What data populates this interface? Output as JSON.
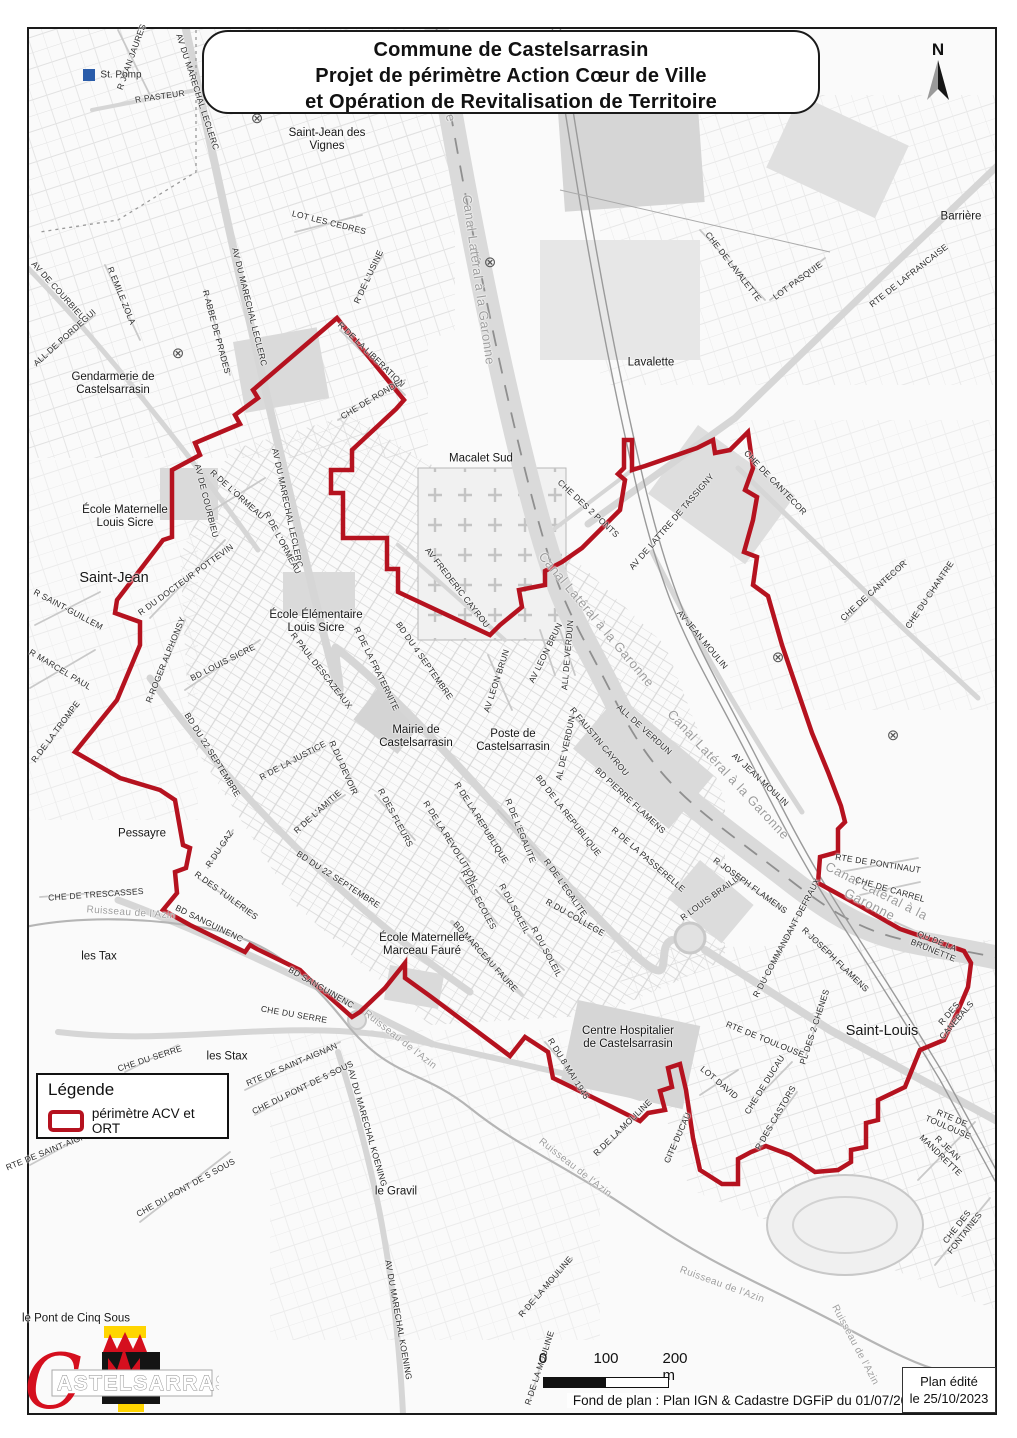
{
  "title_box": {
    "lines": [
      "Commune de Castelsarrasin",
      "Projet de périmètre Action Cœur de Ville",
      "et Opération de Revitalisation de Territoire"
    ]
  },
  "north_label": "N",
  "legend": {
    "title": "Légende",
    "item_label": "périmètre ACV et ORT"
  },
  "scale_bar": {
    "tick0": "0",
    "tick1": "100",
    "tick2": "200 m"
  },
  "credits": {
    "basemap": "Fond de plan : Plan IGN & Cadastre DGFiP du 01/07/2023",
    "edited_line1": "Plan édité",
    "edited_line2": "le 25/10/2023"
  },
  "logo": {
    "initial": "C",
    "name": "ASTELSARRASIN"
  },
  "colors": {
    "perimeter": "#b5121f",
    "canal_label": "#9c9c9c",
    "st_pomp_blue": "#2a5caa",
    "logo_red": "#d50f1e",
    "logo_yellow": "#ffd500",
    "logo_black": "#141414"
  },
  "perimeter_path": "M337,318 L404,400 L396,409 L352,450 L352,470 L331,470 L331,493 L343,493 L343,538 L387,538 L387,569 L398,569 L398,592 L490,635 L500,625 L522,607 L519,590 L545,585 L545,571 L562,562 L582,548 L605,525 L620,510 L625,480 L618,474 L624,468 L624,440 L632,440 L632,470 L645,466 L697,448 L713,440 L715,453 L730,450 L748,432 L753,468 L745,490 L757,497 L753,520 L744,552 L757,557 L753,585 L768,596 L782,645 L798,692 L812,733 L828,772 L841,806 L845,822 L838,829 L838,852 L820,857 L818,883 L860,906 L900,929 L944,944 L964,951 L971,963 L968,987 L957,1013 L944,1040 L920,1050 L905,1087 L878,1100 L878,1120 L866,1123 L866,1147 L851,1150 L851,1162 L838,1170 L815,1172 L790,1155 L766,1146 L751,1152 L738,1159 L738,1184 L722,1184 L700,1170 L693,1138 L686,1090 L680,1064 L668,1068 L672,1087 L660,1091 L665,1110 L648,1113 L640,1121 L598,1100 L553,1078 L548,1052 L525,1037 L510,1056 L430,996 L405,978 L405,963 L385,988 L360,1012 L352,1017 L307,977 L300,970 L257,949 L250,945 L245,952 L190,925 L163,910 L177,893 L175,872 L186,868 L190,848 L183,845 L175,800 L160,790 L120,778 L75,752 L117,700 L140,645 L140,622 L115,613 L117,600 L163,540 L172,537 L172,470 L200,455 L195,443 L240,424 L235,415 L258,398 L253,390 Z",
  "symbols": [
    {
      "x": 257,
      "y": 118
    },
    {
      "x": 178,
      "y": 353
    },
    {
      "x": 490,
      "y": 262
    },
    {
      "x": 778,
      "y": 657
    },
    {
      "x": 893,
      "y": 735
    }
  ],
  "map_labels": [
    {
      "t": "R JEAN JAURES",
      "x": 132,
      "y": 57,
      "r": -70
    },
    {
      "t": "R PASTEUR",
      "x": 160,
      "y": 97,
      "r": -8
    },
    {
      "t": "AV DU MARECHAL LECLERC",
      "x": 197,
      "y": 92,
      "r": 72
    },
    {
      "t": "St. Pomp",
      "x": 121,
      "y": 75,
      "c": "pl-sm"
    },
    {
      "t": "Saint-Jean des\nVignes",
      "x": 327,
      "y": 140,
      "c": "pl"
    },
    {
      "t": "LOT LES CEDRES",
      "x": 329,
      "y": 223,
      "r": 14
    },
    {
      "t": "R DE L'USINE",
      "x": 369,
      "y": 277,
      "r": -65
    },
    {
      "t": "R DE LA LIBERATION",
      "x": 371,
      "y": 355,
      "r": 44
    },
    {
      "t": "CHE DE RONDE",
      "x": 371,
      "y": 400,
      "r": -31
    },
    {
      "t": "Garonne",
      "x": 446,
      "y": 95,
      "r": 80,
      "c": "wt"
    },
    {
      "t": "Canal Latéral à la Garonne",
      "x": 478,
      "y": 280,
      "r": 82,
      "c": "wt"
    },
    {
      "t": "Macalet Sud",
      "x": 481,
      "y": 459,
      "c": "pl"
    },
    {
      "t": "Lavalette",
      "x": 651,
      "y": 363,
      "c": "pl"
    },
    {
      "t": "CHE DE LAVALETTE",
      "x": 733,
      "y": 267,
      "r": 52
    },
    {
      "t": "LOT PASQUIE",
      "x": 798,
      "y": 281,
      "r": -36
    },
    {
      "t": "RTE DE LAFRANCAISE",
      "x": 909,
      "y": 276,
      "r": -38
    },
    {
      "t": "Barrière",
      "x": 961,
      "y": 217,
      "c": "pl"
    },
    {
      "t": "Gendarmerie de\nCastelsarrasin",
      "x": 113,
      "y": 384,
      "c": "pl"
    },
    {
      "t": "AV DE COURBIEU",
      "x": 58,
      "y": 291,
      "r": 48
    },
    {
      "t": "R EMILE ZOLA",
      "x": 121,
      "y": 296,
      "r": 68
    },
    {
      "t": "ALL DE PORDEGUI",
      "x": 65,
      "y": 338,
      "r": -42
    },
    {
      "t": "R ABBE DE PRADES",
      "x": 216,
      "y": 332,
      "r": 75
    },
    {
      "t": "AV DU MARECHAL LECLERC",
      "x": 249,
      "y": 307,
      "r": 76
    },
    {
      "t": "AV DU MARECHAL LECLERC",
      "x": 287,
      "y": 508,
      "r": 78
    },
    {
      "t": "École Maternelle\nLouis Sicre",
      "x": 125,
      "y": 517,
      "c": "pl"
    },
    {
      "t": "Saint-Jean",
      "x": 114,
      "y": 578,
      "c": "pl-lg"
    },
    {
      "t": "R SAINT-GUILLEM",
      "x": 68,
      "y": 610,
      "r": 28
    },
    {
      "t": "R MARCEL PAUL",
      "x": 60,
      "y": 670,
      "r": 31
    },
    {
      "t": "R DE LA TROMPE",
      "x": 56,
      "y": 732,
      "r": -53
    },
    {
      "t": "R DU DOCTEUR POTTEVIN",
      "x": 186,
      "y": 580,
      "r": -36
    },
    {
      "t": "R ROGER ALPHONSY",
      "x": 166,
      "y": 660,
      "r": -68
    },
    {
      "t": "BD LOUIS SICRE",
      "x": 223,
      "y": 663,
      "r": -27
    },
    {
      "t": "AV DE COURBIEU",
      "x": 206,
      "y": 501,
      "r": 76
    },
    {
      "t": "R DE L'ORMEAU",
      "x": 237,
      "y": 495,
      "r": 42
    },
    {
      "t": "R DE L'ORMEAU",
      "x": 282,
      "y": 543,
      "r": 62
    },
    {
      "t": "École Élémentaire\nLouis Sicre",
      "x": 316,
      "y": 622,
      "c": "pl"
    },
    {
      "t": "R PAUL DESCAZEAUX",
      "x": 321,
      "y": 671,
      "r": 52
    },
    {
      "t": "R DE LA FRATERNITE",
      "x": 376,
      "y": 669,
      "r": 64
    },
    {
      "t": "BD DU 4 SEPTEMBRE",
      "x": 424,
      "y": 661,
      "r": 55
    },
    {
      "t": "Mairie de\nCastelsarrasin",
      "x": 416,
      "y": 737,
      "c": "pl"
    },
    {
      "t": "Poste de\nCastelsarrasin",
      "x": 513,
      "y": 741,
      "c": "pl"
    },
    {
      "t": "AV LEON BRUN",
      "x": 497,
      "y": 681,
      "r": -72
    },
    {
      "t": "AV LEON BRUN",
      "x": 546,
      "y": 653,
      "r": -64
    },
    {
      "t": "ALL DE VERDUN",
      "x": 568,
      "y": 655,
      "r": -85
    },
    {
      "t": "ALL DE VERDUN",
      "x": 644,
      "y": 730,
      "r": 42
    },
    {
      "t": "AL DE VERDUN",
      "x": 566,
      "y": 748,
      "r": -78
    },
    {
      "t": "R FAUSTIN CAYROU",
      "x": 599,
      "y": 742,
      "r": 50
    },
    {
      "t": "R DE LA JUSTICE",
      "x": 293,
      "y": 761,
      "r": -28
    },
    {
      "t": "R DU DEVOIR",
      "x": 343,
      "y": 768,
      "r": 66
    },
    {
      "t": "R DE L'AMITIE",
      "x": 318,
      "y": 812,
      "r": -42
    },
    {
      "t": "R DES FLEURS",
      "x": 395,
      "y": 818,
      "r": 62
    },
    {
      "t": "BD DU 22 SEPTEMBRE",
      "x": 212,
      "y": 755,
      "r": 58
    },
    {
      "t": "BD DU 22 SEPTEMBRE",
      "x": 338,
      "y": 880,
      "r": 33
    },
    {
      "t": "R DE LA REVOLUTION",
      "x": 450,
      "y": 842,
      "r": 58
    },
    {
      "t": "R DE LA REPUBLIQUE",
      "x": 481,
      "y": 823,
      "r": 58
    },
    {
      "t": "R DE L'EGALITE",
      "x": 520,
      "y": 831,
      "r": 68
    },
    {
      "t": "R DE L'EGALITE",
      "x": 565,
      "y": 888,
      "r": 55
    },
    {
      "t": "BD DE LA REPUBLIQUE",
      "x": 568,
      "y": 816,
      "r": 52
    },
    {
      "t": "R DU COLLEGE",
      "x": 575,
      "y": 918,
      "r": 30
    },
    {
      "t": "R DES ECOLES",
      "x": 478,
      "y": 900,
      "r": 62
    },
    {
      "t": "R DU SOLEIL",
      "x": 514,
      "y": 909,
      "r": 62
    },
    {
      "t": "R DU SOLEIL",
      "x": 546,
      "y": 952,
      "r": 62
    },
    {
      "t": "BD MARCEAU FAURE",
      "x": 485,
      "y": 957,
      "r": 48
    },
    {
      "t": "École Maternelle\nMarceau Fauré",
      "x": 422,
      "y": 945,
      "c": "pl"
    },
    {
      "t": "Pessayre",
      "x": 142,
      "y": 834,
      "c": "pl"
    },
    {
      "t": "CHE DE TRESCASSES",
      "x": 96,
      "y": 895,
      "r": -4
    },
    {
      "t": "Ruisseau de l'Azin",
      "x": 131,
      "y": 913,
      "r": 4,
      "c": "wt-sm"
    },
    {
      "t": "les Tax",
      "x": 99,
      "y": 957,
      "c": "pl"
    },
    {
      "t": "R DU GAZ",
      "x": 220,
      "y": 849,
      "r": -56
    },
    {
      "t": "R DES TUILERIES",
      "x": 226,
      "y": 896,
      "r": 36
    },
    {
      "t": "BD SANGUINENC",
      "x": 209,
      "y": 924,
      "r": 26
    },
    {
      "t": "BD SANGUINENC",
      "x": 321,
      "y": 988,
      "r": 30
    },
    {
      "t": "CHE DU SERRE",
      "x": 294,
      "y": 1015,
      "r": 10
    },
    {
      "t": "CHE DU SERRE",
      "x": 150,
      "y": 1059,
      "r": -18
    },
    {
      "t": "les Stax",
      "x": 227,
      "y": 1057,
      "c": "pl"
    },
    {
      "t": "RTE DE SAINT-AIGNAN",
      "x": 292,
      "y": 1065,
      "r": -23
    },
    {
      "t": "RTE DE SAINT-AIGNAN",
      "x": 52,
      "y": 1150,
      "r": -22
    },
    {
      "t": "CHE DU PONT DE 5 SOUS",
      "x": 303,
      "y": 1088,
      "r": -26
    },
    {
      "t": "CHE DU PONT DE 5 SOUS",
      "x": 186,
      "y": 1188,
      "r": -29
    },
    {
      "t": "AV DU MARECHAL KOENING",
      "x": 367,
      "y": 1128,
      "r": 74
    },
    {
      "t": "AV DU MARECHAL KOENING",
      "x": 398,
      "y": 1320,
      "r": 80
    },
    {
      "t": "le Gravil",
      "x": 396,
      "y": 1192,
      "c": "pl"
    },
    {
      "t": "R DE LA MOULINE",
      "x": 623,
      "y": 1128,
      "r": -44
    },
    {
      "t": "R DE LA MOULINE",
      "x": 546,
      "y": 1287,
      "r": -49
    },
    {
      "t": "R DE LA MOULINE",
      "x": 540,
      "y": 1368,
      "r": -72
    },
    {
      "t": "Ruisseau de l'Azin",
      "x": 400,
      "y": 1040,
      "r": 38,
      "c": "wt-sm"
    },
    {
      "t": "Ruisseau de l'Azin",
      "x": 575,
      "y": 1168,
      "r": 38,
      "c": "wt-sm"
    },
    {
      "t": "Ruisseau de l'Azin",
      "x": 722,
      "y": 1285,
      "r": 20,
      "c": "wt-sm"
    },
    {
      "t": "Ruisseau de l'Azin",
      "x": 855,
      "y": 1345,
      "r": 62,
      "c": "wt-sm"
    },
    {
      "t": "Centre Hospitalier\nde Castelsarrasin",
      "x": 628,
      "y": 1038,
      "c": "pl"
    },
    {
      "t": "R DU 8 MAI 1945",
      "x": 568,
      "y": 1069,
      "r": 58
    },
    {
      "t": "CITE DUCAU",
      "x": 678,
      "y": 1138,
      "r": -66
    },
    {
      "t": "LOT DAVID",
      "x": 719,
      "y": 1083,
      "r": 40
    },
    {
      "t": "CHE DE DUCAU",
      "x": 765,
      "y": 1085,
      "r": -58
    },
    {
      "t": "R DES CASTORS",
      "x": 776,
      "y": 1118,
      "r": -60
    },
    {
      "t": "PL DES 2 CHENES",
      "x": 815,
      "y": 1027,
      "r": -72
    },
    {
      "t": "RTE DE TOULOUSE",
      "x": 765,
      "y": 1040,
      "r": 22
    },
    {
      "t": "RTE DE TOULOUSE",
      "x": 950,
      "y": 1123,
      "r": 23
    },
    {
      "t": "R JEAN MANDRETTE",
      "x": 944,
      "y": 1152,
      "r": 44
    },
    {
      "t": "CHE DES FONTAINES",
      "x": 961,
      "y": 1230,
      "r": -52
    },
    {
      "t": "Saint-Louis",
      "x": 882,
      "y": 1031,
      "c": "pl-lg"
    },
    {
      "t": "R LOUIS BRAILLE",
      "x": 712,
      "y": 897,
      "r": -36
    },
    {
      "t": "R JOSEPH FLAMENS",
      "x": 750,
      "y": 886,
      "r": 36
    },
    {
      "t": "R JOSEPH FLAMENS",
      "x": 835,
      "y": 960,
      "r": 44
    },
    {
      "t": "R DU COMMANDANT DEFRAUX",
      "x": 787,
      "y": 938,
      "r": -62
    },
    {
      "t": "BD PIERRE FLAMENS",
      "x": 630,
      "y": 801,
      "r": 43
    },
    {
      "t": "R DE LA PASSERELLE",
      "x": 648,
      "y": 860,
      "r": 41
    },
    {
      "t": "AV JEAN MOULIN",
      "x": 702,
      "y": 640,
      "r": 50
    },
    {
      "t": "AV JEAN MOULIN",
      "x": 760,
      "y": 780,
      "r": 43
    },
    {
      "t": "Canal Latéral à la Garonne",
      "x": 596,
      "y": 620,
      "r": 50,
      "c": "wt"
    },
    {
      "t": "Canal Latéral à la Garonne",
      "x": 728,
      "y": 775,
      "r": 47,
      "c": "wt"
    },
    {
      "t": "Canal Latéral à la Garonne",
      "x": 873,
      "y": 898,
      "r": 27,
      "c": "wt"
    },
    {
      "t": "QU DE LA BRUNETTE",
      "x": 935,
      "y": 946,
      "r": 22
    },
    {
      "t": "RTE DE PONTINAUT",
      "x": 878,
      "y": 864,
      "r": 9
    },
    {
      "t": "CHE DE CARREL",
      "x": 890,
      "y": 890,
      "r": 16
    },
    {
      "t": "CHE DE CANTECOR",
      "x": 775,
      "y": 483,
      "r": 46
    },
    {
      "t": "CHE DE CANTECOR",
      "x": 874,
      "y": 591,
      "r": -42
    },
    {
      "t": "CHE DU CHANTRE",
      "x": 930,
      "y": 595,
      "r": -56
    },
    {
      "t": "CHE DES 2 PONTS",
      "x": 588,
      "y": 509,
      "r": 43
    },
    {
      "t": "AV DE LATTRE DE TASSIGNY",
      "x": 672,
      "y": 522,
      "r": -49
    },
    {
      "t": "AV FREDERIC CAYROU",
      "x": 457,
      "y": 588,
      "r": 52
    },
    {
      "t": "R DES CANEBALS",
      "x": 953,
      "y": 1017,
      "r": -49
    },
    {
      "t": "le Pont de Cinq Sous",
      "x": 76,
      "y": 1319,
      "c": "pl"
    }
  ]
}
